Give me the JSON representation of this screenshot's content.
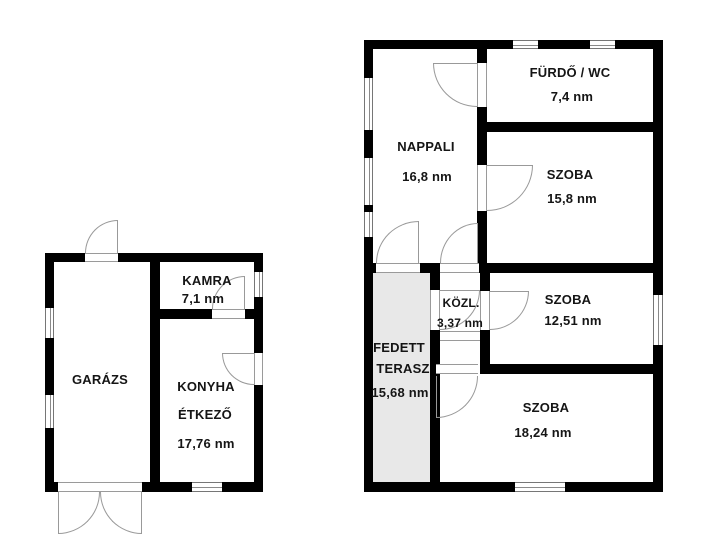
{
  "plan": {
    "type": "floor-plan",
    "unit": "nm",
    "colors": {
      "wall": "#000000",
      "door_window_lines": "#999999",
      "terrace_fill": "#e8e8e8",
      "background": "#ffffff",
      "text": "#151515"
    }
  },
  "left_building": {
    "rooms": {
      "garazs": {
        "name": "GARÁZS"
      },
      "kamra": {
        "name": "KAMRA",
        "area": "7,1 nm"
      },
      "konyha": {
        "name": "KONYHA",
        "name2": "ÉTKEZŐ",
        "area": "17,76 nm"
      }
    }
  },
  "right_building": {
    "rooms": {
      "furdo": {
        "name": "FÜRDŐ / WC",
        "area": "7,4 nm"
      },
      "nappali": {
        "name": "NAPPALI",
        "area": "16,8 nm"
      },
      "szoba1": {
        "name": "SZOBA",
        "area": "15,8 nm"
      },
      "kozl": {
        "name": "KÖZL.",
        "area": "3,37 nm"
      },
      "szoba2": {
        "name": "SZOBA",
        "area": "12,51 nm"
      },
      "terasz": {
        "name_line1": "FEDETT",
        "name_line2": "TERASZ",
        "area": "15,68 nm"
      },
      "szoba3": {
        "name": "SZOBA",
        "area": "18,24 nm"
      }
    }
  }
}
